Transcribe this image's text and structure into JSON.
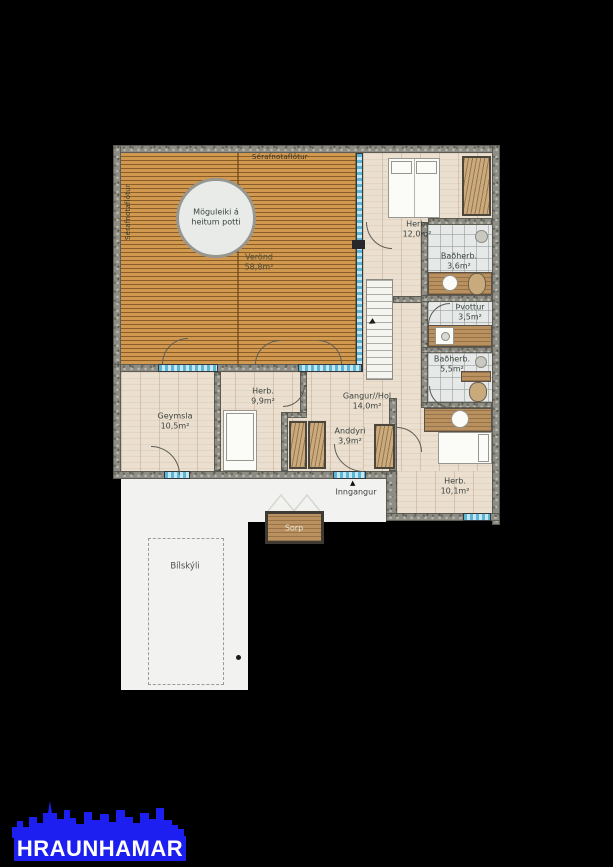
{
  "plan": {
    "outdoor": {
      "top_edge_label": "Sérafnotaflötur",
      "left_edge_label": "Sérafnotaflötur",
      "hot_tub_note_line1": "Möguleiki á",
      "hot_tub_note_line2": "heitum potti",
      "deck_name": "Verönd",
      "deck_size": "58,8m²"
    },
    "rooms": [
      {
        "name": "Herb.",
        "size": "12,0m²"
      },
      {
        "name": "Baðherb.",
        "size": "3,6m²"
      },
      {
        "name": "Þvottur",
        "size": "3,5m²"
      },
      {
        "name": "Baðherb.",
        "size": "5,5m²"
      },
      {
        "name": "Gangur//Hol",
        "size": "14,0m²"
      },
      {
        "name": "Herb.",
        "size": "9,9m²"
      },
      {
        "name": "Geymsla",
        "size": "10,5m²"
      },
      {
        "name": "Anddyri",
        "size": "3,9m²"
      },
      {
        "name": "Herb.",
        "size": "10,1m²"
      }
    ],
    "entrance_label": "Inngangur",
    "entrance_arrow": "▲",
    "stair_arrow": "▲",
    "waste_label": "Sorp",
    "carport_label": "Bílskýli"
  },
  "branding": {
    "logo_text": "HRAUNHAMAR",
    "logo_color": "#1d1ff0"
  },
  "palette": {
    "background": "#000000",
    "wall": "#8d8d85",
    "deck_wood": "#d19950",
    "floor_wood": "#ebdfd0",
    "tile": "#e6e9e8",
    "glass": "#5db5d5",
    "label_text": "#3b443e"
  }
}
